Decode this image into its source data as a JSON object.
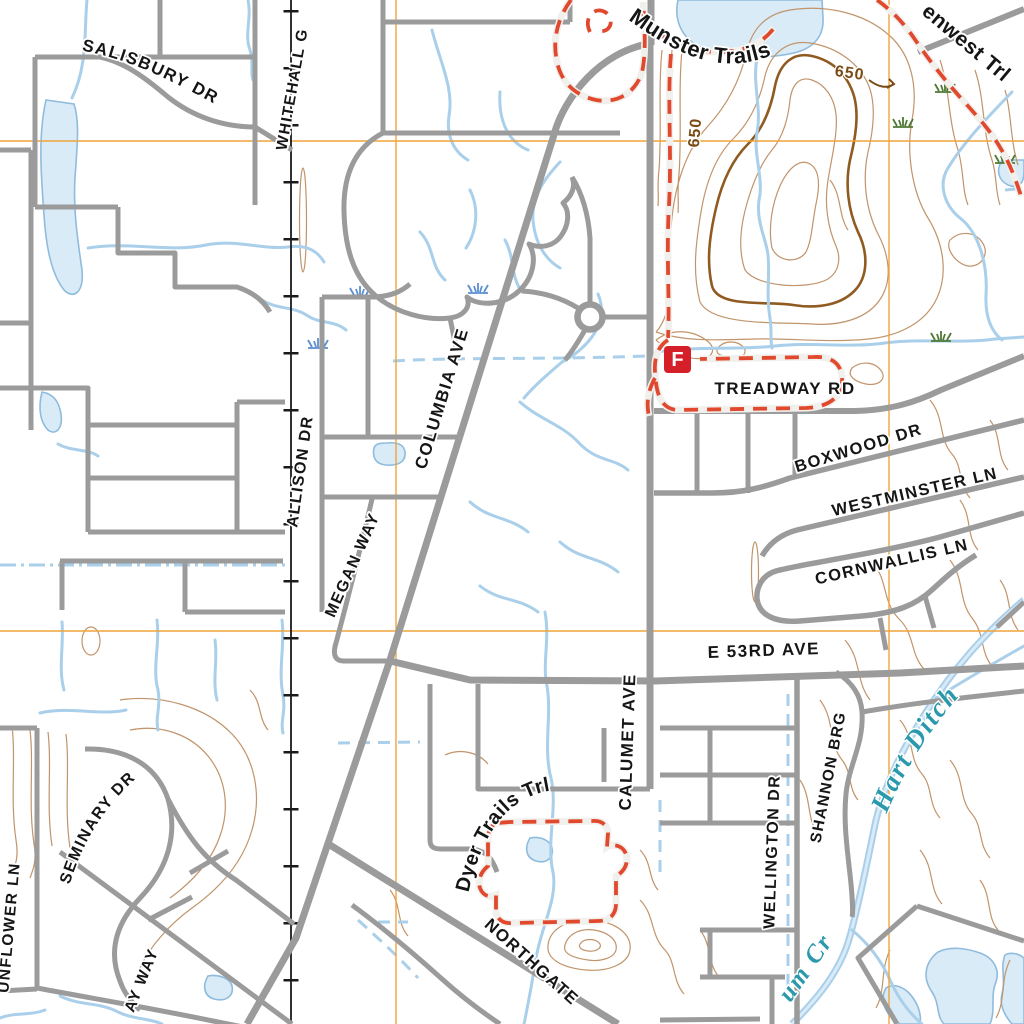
{
  "map": {
    "description": "USGS-style topographic street map tile",
    "labels": {
      "streets": {
        "salisbury": "SALISBURY DR",
        "whitehall": "WHITEHALL G",
        "allison": "ALLISON DR",
        "megan": "MEGAN WAY",
        "columbia": "COLUMBIA AVE",
        "calumet": "CALUMET AVE",
        "treadway": "TREADWAY RD",
        "boxwood": "BOXWOOD DR",
        "westminster": "WESTMINSTER LN",
        "cornwallis": "CORNWALLIS LN",
        "e53rd": "E 53RD AVE",
        "seminary": "SEMINARY DR",
        "sunflower": "UNFLOWER LN",
        "ay_way": "AY WAY",
        "northgate": "NORTHGATE",
        "wellington": "WELLINGTON DR",
        "shannon": "SHANNON BRG"
      },
      "trails": {
        "munster": "Munster Trails",
        "dyer": "Dyer Trails Trl",
        "enwest": "enwest Trl"
      },
      "water": {
        "hart_ditch": "Hart Ditch",
        "plum_cr": "um Cr"
      },
      "contours": {
        "c650_a": "650",
        "c650_b": "650"
      },
      "marker_f": "F"
    },
    "colors": {
      "road": "#9B9B9B",
      "railroad": "#1A1A1A",
      "contour": "#C1946B",
      "contour_index": "#8F5B21",
      "water_line": "#A9CFEA",
      "water_fill": "#D9EBF7",
      "trail": "#E0492E",
      "grid": "#F0A43C",
      "street_label": "#151515",
      "water_label": "#2A99AC",
      "contour_label": "#7A4A14",
      "marker_red": "#D5202A",
      "marsh_green": "#4E7A34",
      "marsh_blue": "#5B8FD0"
    },
    "grid": {
      "vertical_x": [
        396,
        889
      ],
      "horizontal_y": [
        141,
        631
      ]
    }
  }
}
